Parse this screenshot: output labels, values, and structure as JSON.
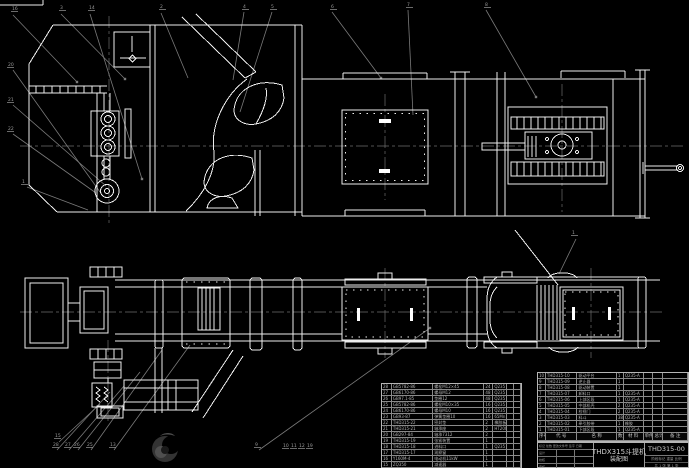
{
  "colors": {
    "background": "#000000",
    "line": "#ededed",
    "leader": "#7a7a7a",
    "centerline": "#6e6e6e",
    "table_text": "#b4b4b4",
    "watermark": "#3a3a3a"
  },
  "title_block": {
    "product_title": "THDX315斗提机",
    "sheet_title": "装配图",
    "drawing_no": "THD315-00",
    "stage_row": "阶段标记  重量  比例",
    "sheet_row": "共 1 张  第 1 张",
    "rev_rows": [
      "标记 处数 更改文件号 签字 日期",
      "设计",
      "校核",
      "审核"
    ]
  },
  "bom_right": {
    "headers": [
      "序号",
      "代 号",
      "名 称",
      "数量",
      "材 料",
      "单件",
      "总计",
      "备 注"
    ],
    "rows": [
      [
        "10",
        "THD315-10",
        "驱动平台",
        "1",
        "Q235-A",
        "",
        ""
      ],
      [
        "9",
        "THD315-09",
        "逆止器",
        "1",
        "",
        "",
        ""
      ],
      [
        "8",
        "THD315-08",
        "驱动装置",
        "1",
        "",
        "",
        ""
      ],
      [
        "7",
        "THD315-07",
        "卸料口",
        "1",
        "Q235-A",
        "",
        ""
      ],
      [
        "6",
        "THD315-06",
        "上部区段",
        "1",
        "Q235-A",
        "",
        ""
      ],
      [
        "5",
        "THD315-05",
        "中部机壳",
        "2",
        "Q235-A",
        "",
        ""
      ],
      [
        "4",
        "THD315-04",
        "检视门",
        "2",
        "Q235-A",
        "",
        ""
      ],
      [
        "3",
        "THD315-03",
        "料斗",
        "38",
        "Q235-A",
        "",
        ""
      ],
      [
        "2",
        "THD315-02",
        "牵引胶带",
        "1",
        "橡胶",
        "",
        ""
      ],
      [
        "1",
        "THD315-01",
        "下部区段",
        "1",
        "Q235-A",
        "",
        ""
      ]
    ]
  },
  "bom_left": {
    "rows": [
      [
        "28",
        "GB5782-86",
        "螺栓M12×45",
        "24",
        "Q235",
        "",
        ""
      ],
      [
        "27",
        "GB6170-86",
        "螺母M12",
        "48",
        "Q235",
        "",
        ""
      ],
      [
        "26",
        "GB97.1-85",
        "垫圈12",
        "48",
        "Q235",
        "",
        ""
      ],
      [
        "25",
        "GB5782-86",
        "螺栓M10×35",
        "16",
        "Q235",
        "",
        ""
      ],
      [
        "24",
        "GB6170-86",
        "螺母M10",
        "16",
        "Q235",
        "",
        ""
      ],
      [
        "23",
        "GB93-87",
        "弹簧垫圈10",
        "16",
        "65Mn",
        "",
        ""
      ],
      [
        "22",
        "THD315-22",
        "密封垫",
        "2",
        "橡胶板",
        "",
        ""
      ],
      [
        "21",
        "THD315-21",
        "轴承座",
        "2",
        "HT200",
        "",
        ""
      ],
      [
        "20",
        "GB297-84",
        "轴承7312",
        "2",
        "",
        "",
        ""
      ],
      [
        "19",
        "THD315-19",
        "张紧装置",
        "1",
        "",
        "",
        ""
      ],
      [
        "18",
        "THD315-18",
        "进料口",
        "1",
        "Q235",
        "",
        ""
      ],
      [
        "17",
        "THD315-17",
        "观察窗",
        "1",
        "",
        "",
        ""
      ],
      [
        "16",
        "Y160M-4",
        "电动机11kW",
        "1",
        "",
        "",
        ""
      ],
      [
        "15",
        "ZQ350",
        "减速器",
        "1",
        "",
        "",
        ""
      ]
    ]
  },
  "callouts": [
    {
      "x": 12,
      "y": 10,
      "n": "16"
    },
    {
      "x": 60,
      "y": 9,
      "n": "3"
    },
    {
      "x": 89,
      "y": 9,
      "n": "14"
    },
    {
      "x": 160,
      "y": 8,
      "n": "2"
    },
    {
      "x": 243,
      "y": 8,
      "n": "4"
    },
    {
      "x": 271,
      "y": 8,
      "n": "5"
    },
    {
      "x": 331,
      "y": 8,
      "n": "6"
    },
    {
      "x": 407,
      "y": 6,
      "n": "7"
    },
    {
      "x": 485,
      "y": 6,
      "n": "8"
    },
    {
      "x": 8,
      "y": 66,
      "n": "20"
    },
    {
      "x": 8,
      "y": 101,
      "n": "21"
    },
    {
      "x": 8,
      "y": 130,
      "n": "22"
    },
    {
      "x": 22,
      "y": 183,
      "n": "1"
    },
    {
      "x": 55,
      "y": 437,
      "n": "15"
    },
    {
      "x": 53,
      "y": 446,
      "n": "28"
    },
    {
      "x": 65,
      "y": 446,
      "n": "27"
    },
    {
      "x": 74,
      "y": 446,
      "n": "26"
    },
    {
      "x": 87,
      "y": 446,
      "n": "25"
    },
    {
      "x": 110,
      "y": 446,
      "n": "13"
    },
    {
      "x": 255,
      "y": 446,
      "n": "9"
    },
    {
      "x": 283,
      "y": 447,
      "n": "10"
    },
    {
      "x": 291,
      "y": 447,
      "n": "11"
    },
    {
      "x": 299,
      "y": 447,
      "n": "12"
    },
    {
      "x": 307,
      "y": 447,
      "n": "19"
    },
    {
      "x": 572,
      "y": 234,
      "n": "1"
    }
  ]
}
